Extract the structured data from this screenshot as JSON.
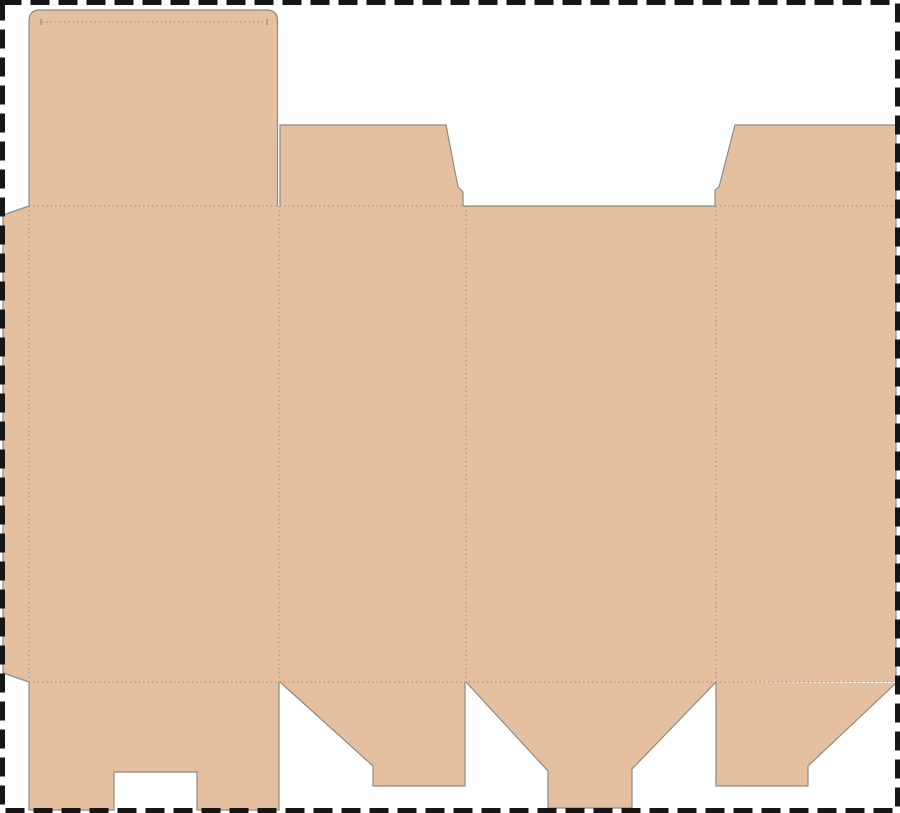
{
  "canvas": {
    "width": 900,
    "height": 813,
    "background_color": "#ffffff"
  },
  "border": {
    "style": "dashed",
    "color": "#161616",
    "thickness": 5,
    "dash_length": 19,
    "dash_gap": 9,
    "inset": 2.5
  },
  "colors": {
    "cardboard_fill": "#e4c0a0",
    "cut_line": "#8e8a84",
    "fold_line": "#9c7d66"
  },
  "dieline": {
    "fills": [
      {
        "name": "glue-tab",
        "type": "polygon",
        "points": [
          [
            29,
            206
          ],
          [
            3,
            215
          ],
          [
            3,
            673
          ],
          [
            29,
            682
          ]
        ]
      },
      {
        "name": "tuck-lid-flap",
        "type": "rounded_top_rect",
        "x": 29,
        "y": 10,
        "width": 248.5,
        "height": 196,
        "radius": 11
      },
      {
        "name": "top-dust-flap-left",
        "type": "polygon",
        "points": [
          [
            280,
            206
          ],
          [
            280,
            125
          ],
          [
            446,
            125
          ],
          [
            458,
            187
          ],
          [
            463,
            192
          ],
          [
            463,
            206
          ]
        ]
      },
      {
        "name": "top-dust-flap-right",
        "type": "polygon",
        "points": [
          [
            715,
            206
          ],
          [
            715,
            190
          ],
          [
            719,
            187
          ],
          [
            735,
            125
          ],
          [
            896,
            125
          ],
          [
            896,
            206
          ]
        ]
      },
      {
        "name": "main-panels-body",
        "type": "polygon",
        "points": [
          [
            29,
            206
          ],
          [
            896,
            206
          ],
          [
            896,
            682
          ],
          [
            29,
            682
          ]
        ]
      },
      {
        "name": "bottom-lock-flap",
        "type": "polygon",
        "points": [
          [
            29,
            682
          ],
          [
            279,
            682
          ],
          [
            279,
            810
          ],
          [
            197,
            810
          ],
          [
            197,
            772
          ],
          [
            114,
            772
          ],
          [
            114,
            810
          ],
          [
            29,
            810
          ]
        ]
      },
      {
        "name": "bottom-dust-flap-left",
        "type": "polygon",
        "points": [
          [
            280,
            682
          ],
          [
            465,
            682
          ],
          [
            465,
            786
          ],
          [
            373,
            786
          ],
          [
            373,
            766
          ]
        ]
      },
      {
        "name": "bottom-tongue-flap",
        "type": "polygon",
        "points": [
          [
            466,
            682
          ],
          [
            716,
            682
          ],
          [
            632,
            769
          ],
          [
            632,
            808
          ],
          [
            548,
            808
          ],
          [
            548,
            771
          ]
        ]
      },
      {
        "name": "bottom-dust-flap-right",
        "type": "polygon",
        "points": [
          [
            716,
            682
          ],
          [
            896,
            683
          ],
          [
            808,
            766
          ],
          [
            808,
            786
          ],
          [
            716,
            786
          ]
        ]
      }
    ],
    "cut_lines": [
      {
        "name": "glue-tab-edge",
        "type": "polyline",
        "points": [
          [
            29,
            206
          ],
          [
            3,
            215
          ],
          [
            3,
            673
          ],
          [
            29,
            682
          ]
        ]
      },
      {
        "name": "tuck-lid-edge",
        "type": "rounded_top_outline",
        "x": 29,
        "y": 10,
        "width": 248.5,
        "height": 196,
        "radius": 11
      },
      {
        "name": "lid-fold-slit-left",
        "type": "polyline",
        "points": [
          [
            41,
            19
          ],
          [
            41,
            25
          ]
        ]
      },
      {
        "name": "lid-fold-slit-right",
        "type": "polyline",
        "points": [
          [
            267,
            19
          ],
          [
            267,
            25
          ]
        ]
      },
      {
        "name": "top-dust-flap-left-edge",
        "type": "polyline",
        "points": [
          [
            280,
            206
          ],
          [
            280,
            125
          ],
          [
            446,
            125
          ],
          [
            458,
            187
          ],
          [
            463,
            192
          ],
          [
            463,
            206
          ]
        ]
      },
      {
        "name": "top-dust-flap-right-edge",
        "type": "polyline",
        "points": [
          [
            715,
            206
          ],
          [
            715,
            190
          ],
          [
            719,
            187
          ],
          [
            735,
            125
          ],
          [
            896,
            125
          ]
        ]
      },
      {
        "name": "body-right-edge",
        "type": "polyline",
        "points": [
          [
            896,
            125
          ],
          [
            896,
            682
          ]
        ]
      },
      {
        "name": "top-gap-cut-edge",
        "type": "polyline",
        "points": [
          [
            463,
            206
          ],
          [
            715,
            206
          ]
        ]
      },
      {
        "name": "bottom-lock-flap-edge",
        "type": "polyline",
        "points": [
          [
            29,
            682
          ],
          [
            29,
            810
          ],
          [
            114,
            810
          ],
          [
            114,
            772
          ],
          [
            197,
            772
          ],
          [
            197,
            810
          ],
          [
            279,
            810
          ],
          [
            279,
            682
          ]
        ]
      },
      {
        "name": "bottom-dust-flap-left-edge",
        "type": "polyline",
        "points": [
          [
            280,
            682
          ],
          [
            373,
            766
          ],
          [
            373,
            786
          ],
          [
            465,
            786
          ],
          [
            465,
            682
          ]
        ]
      },
      {
        "name": "bottom-tongue-flap-edge",
        "type": "polyline",
        "points": [
          [
            466,
            682
          ],
          [
            548,
            771
          ],
          [
            548,
            808
          ],
          [
            632,
            808
          ],
          [
            632,
            769
          ],
          [
            716,
            682
          ]
        ]
      },
      {
        "name": "bottom-dust-flap-right-edge",
        "type": "polyline",
        "points": [
          [
            716,
            682
          ],
          [
            716,
            786
          ],
          [
            808,
            786
          ],
          [
            808,
            766
          ],
          [
            896,
            683
          ]
        ]
      }
    ],
    "fold_lines": [
      {
        "name": "top-main-fold",
        "from": [
          29,
          206
        ],
        "to": [
          896,
          206
        ]
      },
      {
        "name": "bottom-main-fold",
        "from": [
          29,
          682
        ],
        "to": [
          896,
          682
        ]
      },
      {
        "name": "lid-tuck-fold",
        "from": [
          42,
          22
        ],
        "to": [
          266,
          22
        ]
      },
      {
        "name": "glue-tab-fold",
        "from": [
          29,
          206
        ],
        "to": [
          29,
          682
        ]
      },
      {
        "name": "panel-fold-1",
        "from": [
          279,
          206
        ],
        "to": [
          279,
          682
        ]
      },
      {
        "name": "panel-fold-2",
        "from": [
          466,
          206
        ],
        "to": [
          466,
          682
        ]
      },
      {
        "name": "panel-fold-3",
        "from": [
          716,
          206
        ],
        "to": [
          716,
          682
        ]
      }
    ]
  }
}
